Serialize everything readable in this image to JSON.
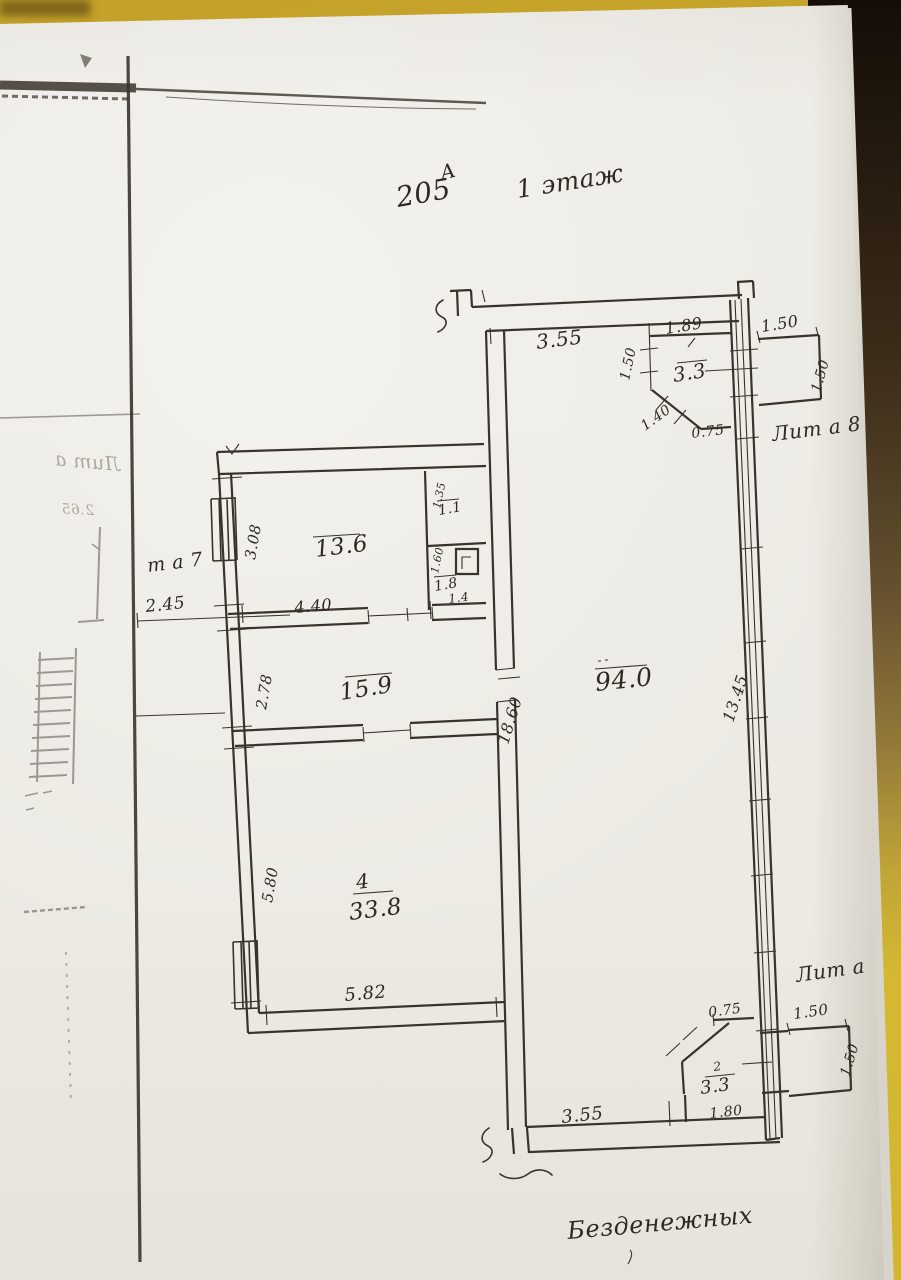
{
  "colors": {
    "surface": "#cfae2b",
    "surface_shadow": "#241a10",
    "paper": "#eceae4",
    "ink": "#3a332b"
  },
  "title": {
    "letter": "А",
    "number": "205",
    "floor": "1 этаж"
  },
  "street_label": "Безденежных",
  "buildings": {
    "lit_a": "Лит а",
    "lit_a8": "Лит а 8",
    "lit_a7": "т а 7"
  },
  "rooms": {
    "r136": {
      "area": "13.6"
    },
    "r159": {
      "area": "15.9"
    },
    "r338": {
      "num": "4",
      "area": "33.8"
    },
    "r940": {
      "area": "94.0"
    },
    "r33_top": {
      "area": "3.3"
    },
    "r33_bottom": {
      "num": "2",
      "area": "3.3"
    },
    "r11": {
      "area": "1.1"
    },
    "r18": {
      "area": "1.8"
    }
  },
  "dims": {
    "hall_top_width": "3.55",
    "annex_top_width": "1.89",
    "annex_top_height": "1.50",
    "annex_top_diag": "1.40",
    "annex_top_cut": "0.75",
    "porch_top_width": "1.50",
    "porch_top_height": "1.50",
    "room136_height": "3.08",
    "room136_width": "4.40",
    "closet_top_height": "1.35",
    "closet_bottom_height": "1.60",
    "closet_width": "1.4",
    "yard_gap": "2.45",
    "room159_height": "2.78",
    "hall_height": "18.60",
    "right_wall_length": "13.45",
    "room338_height": "5.80",
    "room338_width": "5.82",
    "hall_bottom_width": "3.55",
    "annex_bottom_cut": "0.75",
    "annex_bottom_width": "1.80",
    "porch_bottom_width": "1.50",
    "porch_bottom_height": "1.50"
  },
  "bleed_through": {
    "label": "Лит а",
    "dim": "2.65"
  }
}
